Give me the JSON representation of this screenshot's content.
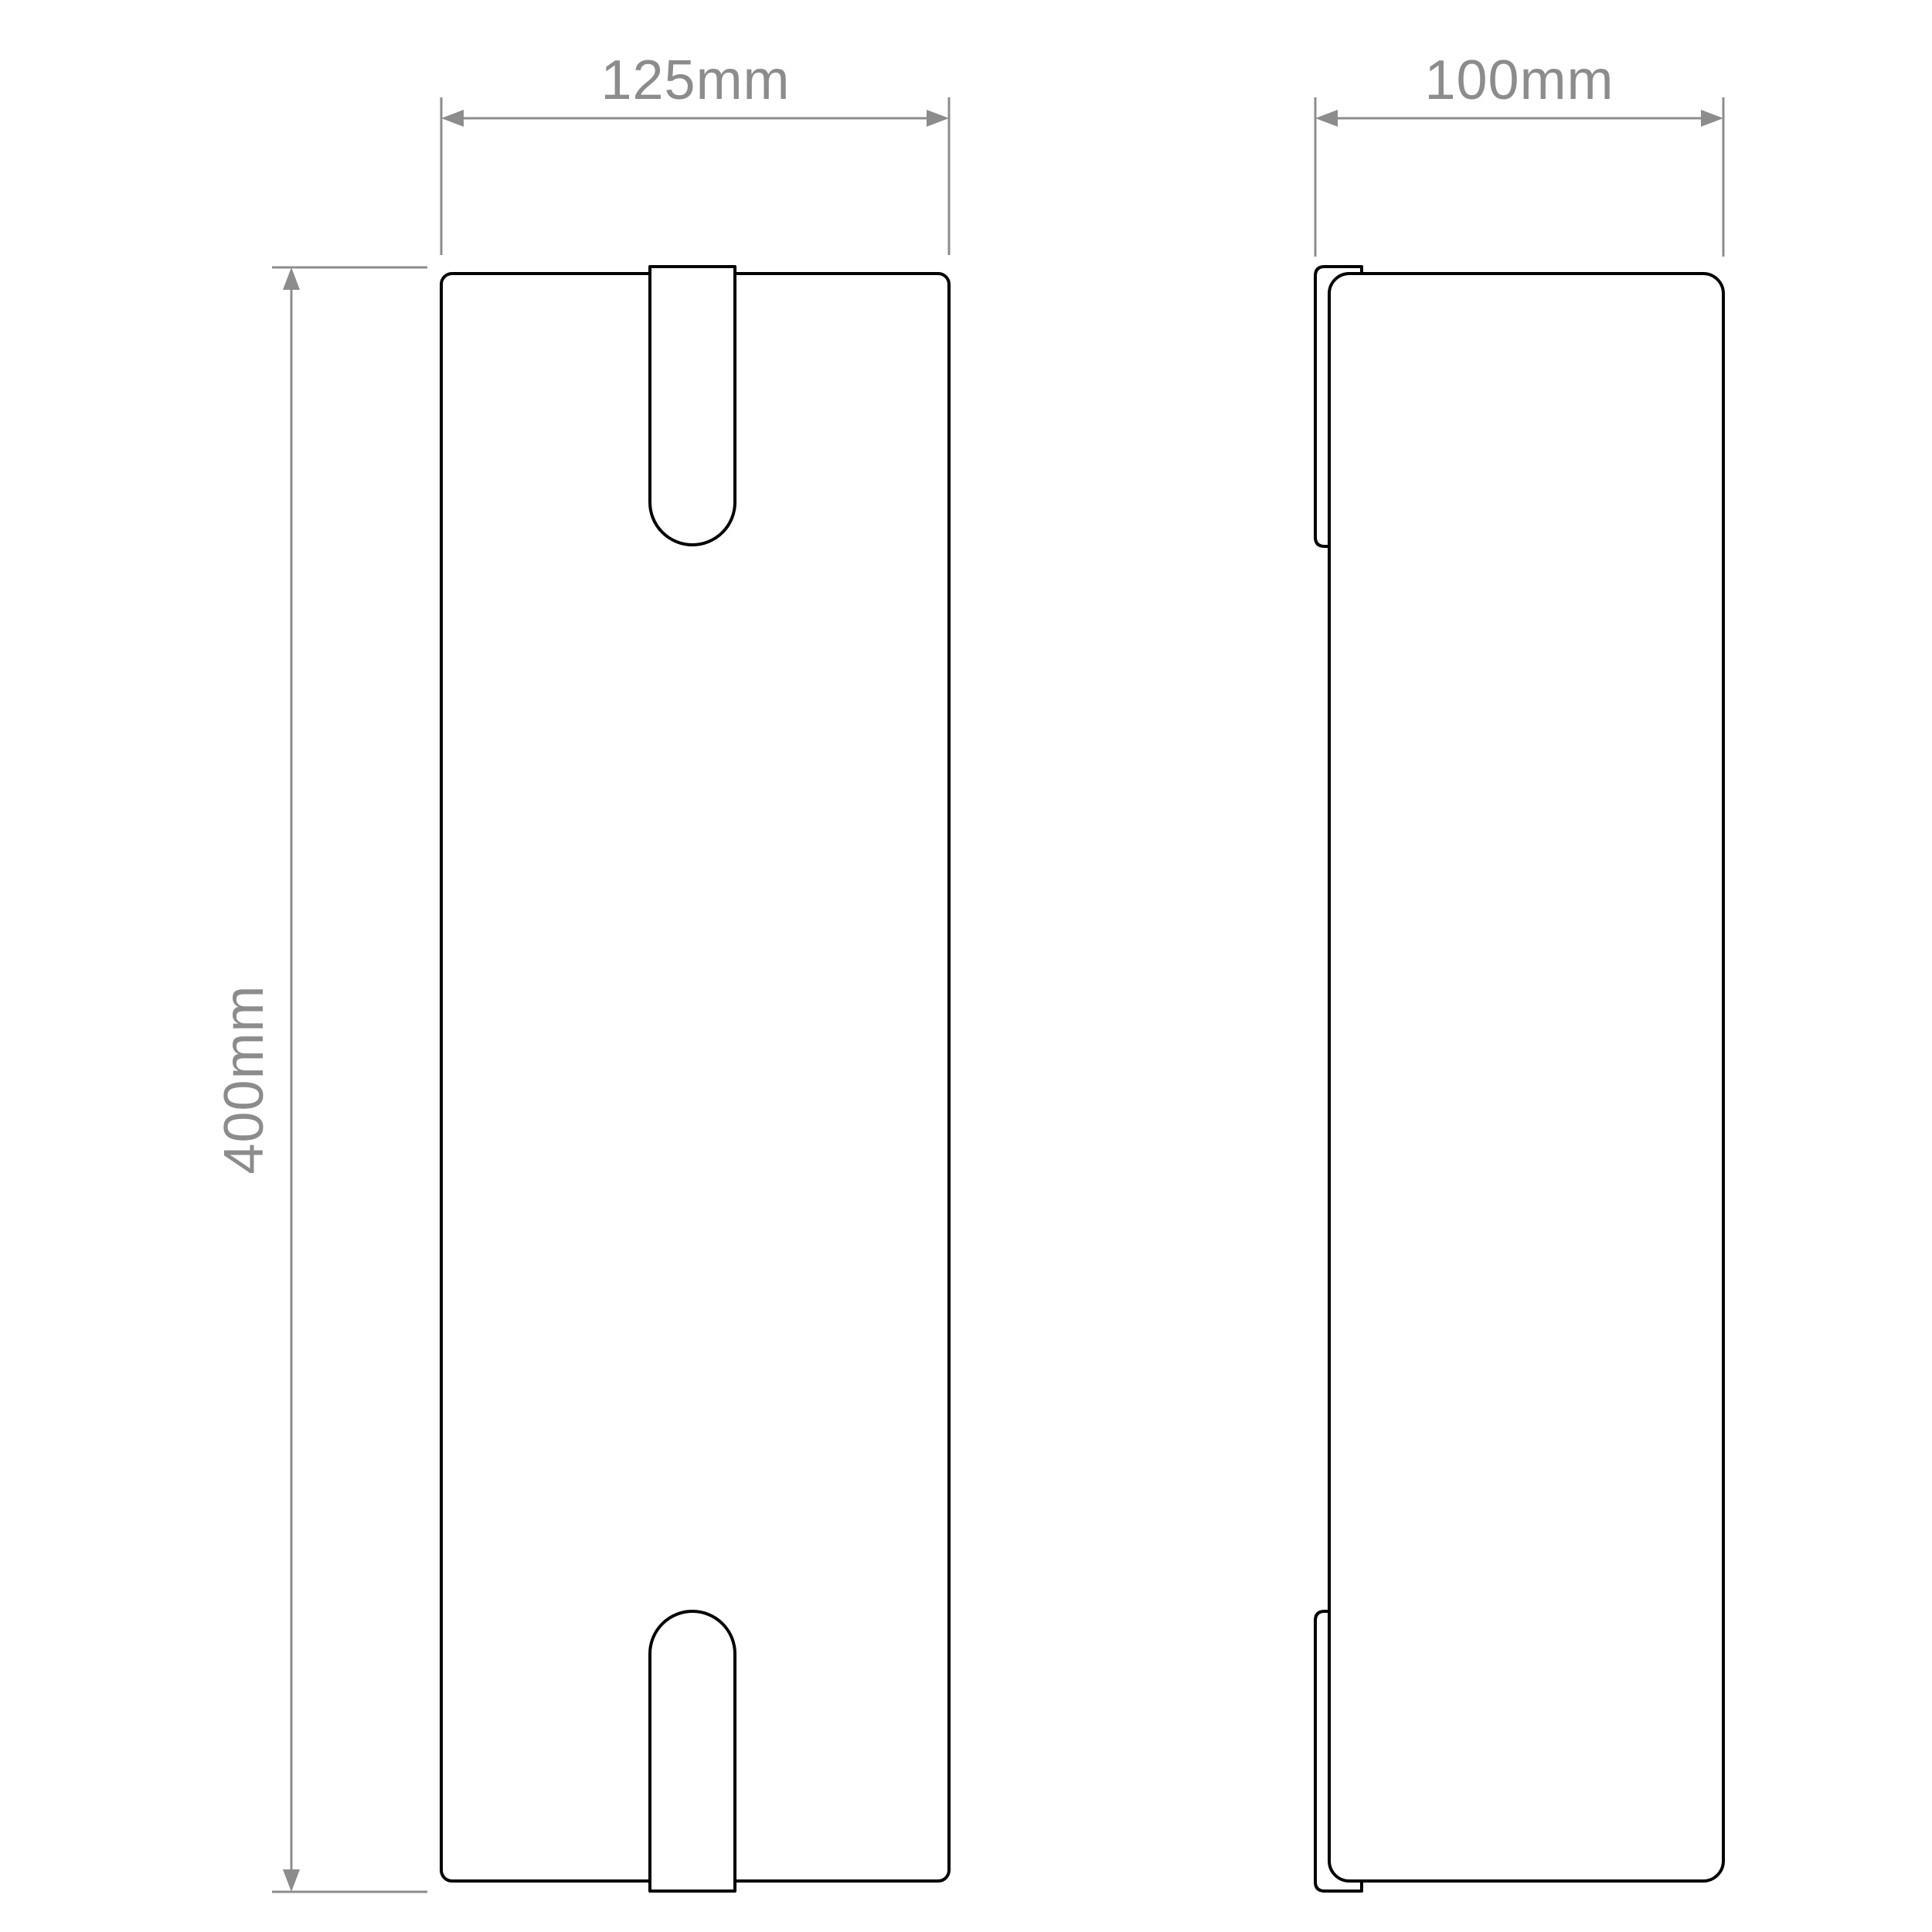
{
  "drawing": {
    "type": "technical-dimension-drawing",
    "views": [
      {
        "id": "front",
        "description": "front elevation of rectangular fixture with top and bottom mounting tabs"
      },
      {
        "id": "side",
        "description": "side elevation of fixture body with wall-bracket strips at top and bottom"
      }
    ],
    "dimensions": {
      "front_width": {
        "label": "125mm",
        "value_mm": 125
      },
      "side_depth": {
        "label": "100mm",
        "value_mm": 100
      },
      "height": {
        "label": "400mm",
        "value_mm": 400
      }
    },
    "colors": {
      "outline": "#000000",
      "dimension": "#8c8c8c",
      "background": "#ffffff"
    }
  }
}
